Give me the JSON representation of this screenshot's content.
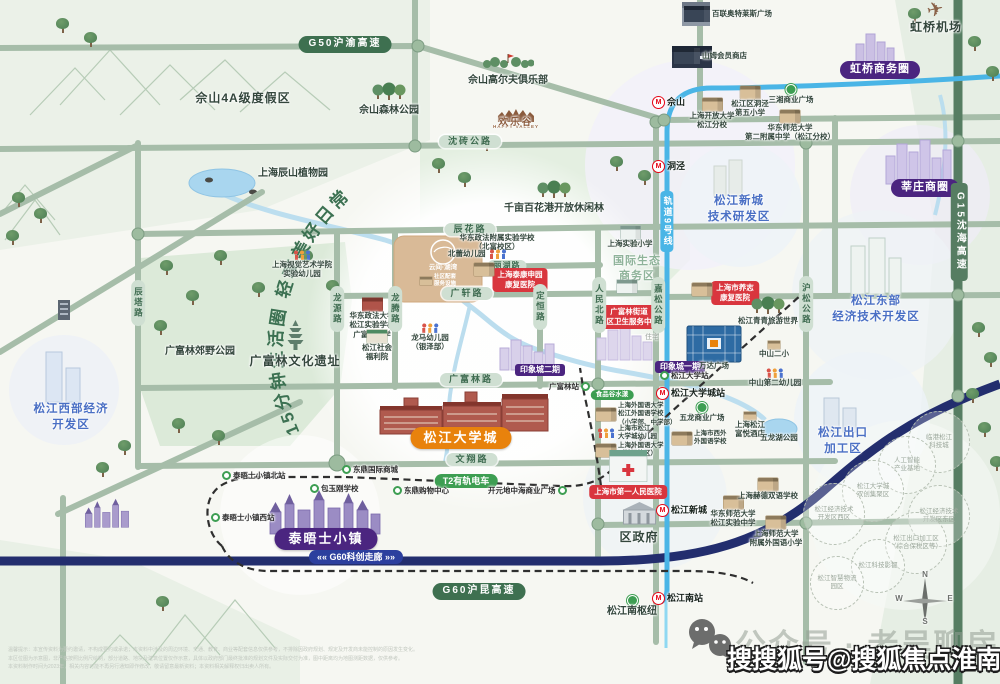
{
  "map": {
    "slogan": "15分钟生活圈  轻享美好日常",
    "labels": [
      {
        "n": "g50-highway-label",
        "l": [
          "G50沪渝高速"
        ],
        "x": 345,
        "y": 36,
        "s": "pd"
      },
      {
        "n": "sheshan-resort-label",
        "l": [
          "佘山4A级度假区"
        ],
        "x": 243,
        "y": 91,
        "s": "big"
      },
      {
        "n": "sheshan-forest-park",
        "l": [
          "佘山森林公园"
        ],
        "x": 389,
        "y": 82,
        "s": "med",
        "i": "trees"
      },
      {
        "n": "sheshan-golf-club",
        "l": [
          "佘山高尔夫俱乐部"
        ],
        "x": 508,
        "y": 52,
        "s": "med",
        "i": "golf"
      },
      {
        "n": "happy-valley-logo",
        "l": [
          "HAPPY VALLEY"
        ],
        "x": 516,
        "y": 108,
        "s": "hve",
        "i": "hvc"
      },
      {
        "n": "happy-valley-label",
        "l": [
          "欢乐谷"
        ],
        "x": 516,
        "y": 117,
        "s": "hv"
      },
      {
        "n": "shenzhuan-road-label",
        "l": [
          "沈砖公路"
        ],
        "x": 470,
        "y": 135,
        "s": "pl"
      },
      {
        "n": "bailian-outlet",
        "l": [
          "百联奥特莱斯广场"
        ],
        "x": 684,
        "y": 6,
        "s": "tiny",
        "r": 1,
        "i": "bldd"
      },
      {
        "n": "hongqiao-airport",
        "l": [
          "虹桥机场"
        ],
        "x": 936,
        "y": 0,
        "s": "big",
        "i": "plane"
      },
      {
        "n": "sams-club",
        "l": [
          "山姆会员商店"
        ],
        "x": 674,
        "y": 48,
        "s": "tiny",
        "r": 1,
        "i": "bldd"
      },
      {
        "n": "hongqiao-business-circle",
        "l": [
          "虹桥商务圈"
        ],
        "x": 880,
        "y": 61,
        "s": "pp"
      },
      {
        "n": "sheshan-metro-station",
        "l": [
          "佘山"
        ],
        "x": 652,
        "y": 96,
        "s": "st",
        "r": 1,
        "i": "m"
      },
      {
        "n": "dongjing-5th-primary",
        "l": [
          "松江区洞泾",
          "第五小学"
        ],
        "x": 750,
        "y": 86,
        "s": "tiny",
        "i": "bld"
      },
      {
        "n": "sanxiang-plaza",
        "l": [
          "三湘商业广场"
        ],
        "x": 791,
        "y": 84,
        "s": "tiny",
        "i": "dg"
      },
      {
        "n": "shanghai-open-univ",
        "l": [
          "上海开放大学",
          "松江分校"
        ],
        "x": 712,
        "y": 98,
        "s": "tiny",
        "i": "bld"
      },
      {
        "n": "ecnu-2nd-high",
        "l": [
          "华东师范大学",
          "第二附属中学（松江分校）"
        ],
        "x": 790,
        "y": 110,
        "s": "tiny",
        "i": "bld"
      },
      {
        "n": "dongjing-metro-station",
        "l": [
          "洞泾"
        ],
        "x": 652,
        "y": 160,
        "s": "st",
        "r": 1,
        "i": "m"
      },
      {
        "n": "xinzhuang-business-circle",
        "l": [
          "莘庄商圈"
        ],
        "x": 925,
        "y": 179,
        "s": "pp"
      },
      {
        "n": "sjxc-tech-zone",
        "l": [
          "松江新城",
          "技术研发区"
        ],
        "x": 739,
        "y": 194,
        "s": "zone"
      },
      {
        "n": "qianmu-baihua-forest",
        "l": [
          "千亩百花港开放休闲林"
        ],
        "x": 554,
        "y": 180,
        "s": "med",
        "i": "trees"
      },
      {
        "n": "chenhua-road-label",
        "l": [
          "辰花路"
        ],
        "x": 470,
        "y": 223,
        "s": "pl"
      },
      {
        "n": "chenshan-botanical-garden",
        "l": [
          "上海辰山植物园"
        ],
        "x": 293,
        "y": 168,
        "s": "med"
      },
      {
        "n": "eco-business-zone",
        "l": [
          "国际生态",
          "商务区"
        ],
        "x": 637,
        "y": 254,
        "s": "sage"
      },
      {
        "n": "sh-experimental-primary",
        "l": [
          "上海实验小学"
        ],
        "x": 630,
        "y": 226,
        "s": "tiny",
        "i": "bldw"
      },
      {
        "n": "ecupl-affiliated-school",
        "l": [
          "华东政法附属实验学校",
          "（北富校区）"
        ],
        "x": 497,
        "y": 233,
        "s": "tiny"
      },
      {
        "n": "beilei-kindergarten",
        "l": [
          "北蕾幼儿园"
        ],
        "x": 448,
        "y": 249,
        "s": "tiny",
        "r": 1,
        "i": "kids",
        "a": 1
      },
      {
        "n": "lihu-road-label",
        "l": [
          "丽湖路"
        ],
        "x": 507,
        "y": 260,
        "s": "pls"
      },
      {
        "n": "taikang-hospital-badge",
        "l": [
          "上海泰康申园",
          "康复医院"
        ],
        "x": 520,
        "y": 268,
        "s": "red"
      },
      {
        "n": "taikang-building",
        "l": [],
        "x": 484,
        "y": 263,
        "s": "ico",
        "i": "bld"
      },
      {
        "n": "guangxuan-road-label",
        "l": [
          "广轩路"
        ],
        "x": 467,
        "y": 287,
        "s": "pl"
      },
      {
        "n": "visual-arts-kindergarten",
        "l": [
          "上海视觉艺术学院",
          "实验幼儿园"
        ],
        "x": 302,
        "y": 250,
        "s": "tiny",
        "i": "kids"
      },
      {
        "n": "gfl-health-center-badge",
        "l": [
          "广富林街道",
          "社区卫生服务中心"
        ],
        "x": 629,
        "y": 305,
        "s": "red"
      },
      {
        "n": "gfl-health-building",
        "l": [],
        "x": 627,
        "y": 280,
        "s": "ico",
        "i": "bldw"
      },
      {
        "n": "yangzhi-hospital-badge",
        "l": [
          "上海市养志",
          "康复医院"
        ],
        "x": 735,
        "y": 281,
        "s": "red"
      },
      {
        "n": "yangzhi-building",
        "l": [],
        "x": 702,
        "y": 283,
        "s": "ico",
        "i": "bld"
      },
      {
        "n": "ecupl-sj-school",
        "l": [
          "华东政法大学",
          "松江实验学校",
          "广富林中学"
        ],
        "x": 372,
        "y": 298,
        "s": "tiny",
        "i": "bldr"
      },
      {
        "n": "sj-welfare-house",
        "l": [
          "松江社会",
          "福利院"
        ],
        "x": 377,
        "y": 330,
        "s": "tiny",
        "i": "bldg"
      },
      {
        "n": "longma-kindergarten",
        "l": [
          "龙马幼儿园",
          "（银泽部）"
        ],
        "x": 430,
        "y": 323,
        "s": "tiny",
        "i": "kids"
      },
      {
        "n": "project-name",
        "l": [
          "云间·湖湾"
        ],
        "x": 443,
        "y": 264,
        "s": "tinyw"
      },
      {
        "n": "project-services",
        "l": [
          "社区配套",
          "服务设施"
        ],
        "x": 420,
        "y": 274,
        "s": "tinyw2",
        "r": 1,
        "i": "blds"
      },
      {
        "n": "gfl-ruins",
        "l": [
          "广富林文化遗址"
        ],
        "x": 295,
        "y": 320,
        "s": "big",
        "i": "pag"
      },
      {
        "n": "gfl-country-park",
        "l": [
          "广富林郊野公园"
        ],
        "x": 200,
        "y": 346,
        "s": "med"
      },
      {
        "n": "sj-west-zone",
        "l": [
          "松江西部经济",
          "开发区"
        ],
        "x": 71,
        "y": 402,
        "s": "zone"
      },
      {
        "n": "chenta-road-label",
        "l": [
          "辰塔路"
        ],
        "x": 138,
        "y": 280,
        "s": "vp"
      },
      {
        "n": "longyuan-road-label",
        "l": [
          "龙源路"
        ],
        "x": 337,
        "y": 286,
        "s": "vp"
      },
      {
        "n": "longteng-road-label",
        "l": [
          "龙腾路"
        ],
        "x": 395,
        "y": 286,
        "s": "vp"
      },
      {
        "n": "dingheng-road-label",
        "l": [
          "定恒路"
        ],
        "x": 540,
        "y": 284,
        "s": "vp"
      },
      {
        "n": "renminbei-road-label",
        "l": [
          "人民北路"
        ],
        "x": 599,
        "y": 277,
        "s": "vp"
      },
      {
        "n": "jiasong-road-label",
        "l": [
          "嘉松公路"
        ],
        "x": 658,
        "y": 277,
        "s": "vp"
      },
      {
        "n": "husong-road-label",
        "l": [
          "沪松公路"
        ],
        "x": 806,
        "y": 276,
        "s": "vp"
      },
      {
        "n": "g15-highway-label",
        "l": [
          "G15沈海高速"
        ],
        "x": 959,
        "y": 183,
        "s": "vpd"
      },
      {
        "n": "metro-line9-label",
        "l": [
          "轨道9号线"
        ],
        "x": 667,
        "y": 191,
        "s": "vpb"
      },
      {
        "n": "residential-label",
        "l": [
          "住宅"
        ],
        "x": 652,
        "y": 334,
        "s": "gray"
      },
      {
        "n": "yinxiangcheng-phase2",
        "l": [
          "印象城二期"
        ],
        "x": 540,
        "y": 364,
        "s": "pps"
      },
      {
        "n": "yinxiangcheng-phase1",
        "l": [
          "印象城一期"
        ],
        "x": 680,
        "y": 361,
        "s": "pps"
      },
      {
        "n": "gfl-road-label",
        "l": [
          "广富林路"
        ],
        "x": 471,
        "y": 373,
        "s": "pl"
      },
      {
        "n": "gfl-tram-stop",
        "l": [
          "广富林站"
        ],
        "x": 549,
        "y": 382,
        "s": "ts",
        "r": 1,
        "i": "tg",
        "a": 1
      },
      {
        "n": "food-valley-badge",
        "l": [
          "食品谷水漾"
        ],
        "x": 612,
        "y": 390,
        "s": "pg"
      },
      {
        "n": "sjdxc-metro-station",
        "l": [
          "松江大学城站"
        ],
        "x": 656,
        "y": 387,
        "s": "st",
        "r": 1,
        "i": "m"
      },
      {
        "n": "sj-east-zone",
        "l": [
          "松江东部",
          "经济技术开发区"
        ],
        "x": 876,
        "y": 294,
        "s": "zone"
      },
      {
        "n": "wulong-plaza-stop",
        "l": [
          "五龙商业广场"
        ],
        "x": 702,
        "y": 402,
        "s": "tiny",
        "i": "dg"
      },
      {
        "n": "sisu-foreign-school",
        "l": [
          "上海外国语大学",
          "松江外国语学校",
          "（小学部、中学部）"
        ],
        "x": 596,
        "y": 402,
        "s": "ts2",
        "r": 1,
        "i": "bld"
      },
      {
        "n": "sjdxc-kindergarten",
        "l": [
          "上海市松江",
          "大学城幼儿园"
        ],
        "x": 596,
        "y": 425,
        "s": "ts2",
        "r": 1,
        "i": "kids"
      },
      {
        "n": "sisu-univ",
        "l": [
          "上海外国语大学",
          "（松江校区）"
        ],
        "x": 596,
        "y": 442,
        "s": "ts2",
        "r": 1,
        "i": "bld"
      },
      {
        "n": "xiwai-school",
        "l": [
          "上海市西外",
          "外国语学校"
        ],
        "x": 672,
        "y": 430,
        "s": "ts2",
        "r": 1,
        "i": "bld"
      },
      {
        "n": "fuyue-hotel",
        "l": [
          "上海松江",
          "富悦酒店"
        ],
        "x": 750,
        "y": 412,
        "s": "tiny",
        "i": "blds"
      },
      {
        "n": "wulong-lake-park",
        "l": [
          "五龙湖公园"
        ],
        "x": 779,
        "y": 433,
        "s": "tiny"
      },
      {
        "n": "sjdx-tram-stop",
        "l": [
          "松江大学站"
        ],
        "x": 660,
        "y": 371,
        "s": "ts",
        "r": 1,
        "i": "tg"
      },
      {
        "n": "wanda-plaza-label",
        "l": [
          "万达广场"
        ],
        "x": 714,
        "y": 361,
        "s": "tiny"
      },
      {
        "n": "zhongshan-2nd-primary",
        "l": [
          "中山二小"
        ],
        "x": 774,
        "y": 341,
        "s": "tiny",
        "i": "blds"
      },
      {
        "n": "zhongshan-2nd-kindergarten",
        "l": [
          "中山第二幼儿园"
        ],
        "x": 775,
        "y": 368,
        "s": "tiny",
        "i": "kids"
      },
      {
        "n": "qingqing-tourism-world",
        "l": [
          "松江青青旅游世界"
        ],
        "x": 768,
        "y": 296,
        "s": "tiny",
        "i": "trees"
      },
      {
        "n": "sjdxc-badge",
        "l": [
          "松江大学城"
        ],
        "x": 461,
        "y": 427,
        "s": "po"
      },
      {
        "n": "wenxiang-road-label",
        "l": [
          "文翔路"
        ],
        "x": 472,
        "y": 453,
        "s": "pl"
      },
      {
        "n": "dongding-intl-stop",
        "l": [
          "东鼎国际商城"
        ],
        "x": 342,
        "y": 465,
        "s": "ts",
        "r": 1,
        "i": "tg"
      },
      {
        "n": "baoyugang-school-stop",
        "l": [
          "包玉刚学校"
        ],
        "x": 310,
        "y": 484,
        "s": "ts",
        "r": 1,
        "i": "tg"
      },
      {
        "n": "t2-tram-badge",
        "l": [
          "T2有轨电车"
        ],
        "x": 466,
        "y": 474,
        "s": "pt"
      },
      {
        "n": "dongding-mall-stop",
        "l": [
          "东鼎购物中心"
        ],
        "x": 393,
        "y": 486,
        "s": "ts",
        "r": 1,
        "i": "tg"
      },
      {
        "n": "kaiyuan-plaza-stop",
        "l": [
          "开元地中海商业广场"
        ],
        "x": 488,
        "y": 486,
        "s": "ts",
        "r": 1,
        "i": "tg",
        "a": 1
      },
      {
        "n": "thames-north-stop",
        "l": [
          "泰晤士小镇北站"
        ],
        "x": 222,
        "y": 471,
        "s": "ts",
        "r": 1,
        "i": "tg"
      },
      {
        "n": "thames-west-stop",
        "l": [
          "泰晤士小镇西站"
        ],
        "x": 211,
        "y": 513,
        "s": "ts",
        "r": 1,
        "i": "tg"
      },
      {
        "n": "thames-town-badge",
        "l": [
          "泰晤士小镇"
        ],
        "x": 326,
        "y": 528,
        "s": "ppb"
      },
      {
        "n": "first-peoples-hospital",
        "l": [
          "上海市第一人民医院"
        ],
        "x": 628,
        "y": 450,
        "s": "red",
        "i": "hosp"
      },
      {
        "n": "district-government",
        "l": [
          "区政府"
        ],
        "x": 639,
        "y": 500,
        "s": "big",
        "i": "gov"
      },
      {
        "n": "sjxc-metro-station",
        "l": [
          "松江新城"
        ],
        "x": 656,
        "y": 504,
        "s": "st",
        "r": 1,
        "i": "m"
      },
      {
        "n": "ecnu-sj-high",
        "l": [
          "华东师范大学",
          "松江实验中学"
        ],
        "x": 733,
        "y": 496,
        "s": "tiny",
        "i": "bld"
      },
      {
        "n": "hede-school",
        "l": [
          "上海赫德双语学校"
        ],
        "x": 768,
        "y": 478,
        "s": "tiny",
        "i": "bld"
      },
      {
        "n": "shnu-foreign-primary",
        "l": [
          "上海师范大学",
          "附属外国语小学"
        ],
        "x": 776,
        "y": 516,
        "s": "tiny",
        "i": "bld"
      },
      {
        "n": "sj-export-zone",
        "l": [
          "松江出口",
          "加工区"
        ],
        "x": 843,
        "y": 426,
        "s": "zone"
      },
      {
        "n": "g60-corridor-badge",
        "l": [
          "«« G60科创走廊 »»"
        ],
        "x": 356,
        "y": 550,
        "s": "pb"
      },
      {
        "n": "g60-highway-label",
        "l": [
          "G60沪昆高速"
        ],
        "x": 479,
        "y": 583,
        "s": "pd"
      },
      {
        "n": "sjn-hub",
        "l": [
          "松江南枢纽"
        ],
        "x": 632,
        "y": 595,
        "s": "med",
        "i": "dg"
      },
      {
        "n": "sjn-metro-station",
        "l": [
          "松江南站"
        ],
        "x": 652,
        "y": 592,
        "s": "st",
        "r": 1,
        "i": "m"
      },
      {
        "n": "compass-n",
        "l": [
          "N"
        ],
        "x": 925,
        "y": 570,
        "s": "cmp"
      },
      {
        "n": "compass-w",
        "l": [
          "W"
        ],
        "x": 899,
        "y": 594,
        "s": "cmp"
      },
      {
        "n": "compass-e",
        "l": [
          "E"
        ],
        "x": 950,
        "y": 594,
        "s": "cmp"
      },
      {
        "n": "compass-s",
        "l": [
          "S"
        ],
        "x": 925,
        "y": 617,
        "s": "cmp"
      }
    ],
    "dashed_circles": [
      {
        "n": "zone-lingang-tech",
        "l": [
          "临港松江",
          "科技城"
        ],
        "x": 938,
        "y": 441,
        "r": 30
      },
      {
        "n": "zone-ai-base",
        "l": [
          "人工智能",
          "产业基地"
        ],
        "x": 906,
        "y": 464,
        "r": 28
      },
      {
        "n": "zone-univ-innovation",
        "l": [
          "松江大学城",
          "双创集聚区"
        ],
        "x": 872,
        "y": 490,
        "r": 30
      },
      {
        "n": "zone-edz-west",
        "l": [
          "松江经济技术",
          "开发区西区"
        ],
        "x": 833,
        "y": 513,
        "r": 30
      },
      {
        "n": "zone-edz-east",
        "l": [
          "松江经济技术",
          "开发区东区"
        ],
        "x": 938,
        "y": 515,
        "r": 30
      },
      {
        "n": "zone-export-bonded",
        "l": [
          "松江出口加工区",
          "（综合保税区等）"
        ],
        "x": 915,
        "y": 542,
        "r": 30
      },
      {
        "n": "zone-film-capital",
        "l": [
          "松江科技影都"
        ],
        "x": 877,
        "y": 565,
        "r": 26
      },
      {
        "n": "zone-smart-logistics",
        "l": [
          "松江智慧物流",
          "园区"
        ],
        "x": 836,
        "y": 582,
        "r": 26
      }
    ]
  },
  "watermark": {
    "gray": "公众号 · 老吴聊房",
    "white": "搜搜狐号@搜狐焦点淮南站"
  },
  "footer": {
    "line1": "温馨提示：本宣传资料为要约邀请，不构成要约或承诺；本资料中涉及的周边环境、交通、教育、商业等配套信息仅供参考，不排除因政府规划、规定及开发商未能控制的原因发生变化。",
    "line2": "本区位图为示意图，非严格按照比例尺绘制，部分道路、地块及建筑位置仅作示意，具体以政府部门最终批准的规划文件及实际交付为准，图中距离均为地图测距数据，仅供参考。",
    "line3": "本资料制作时间为2023年，相关内容可能不再另行通知即作修改，敬请留意最新资料；本资料相关解释权归出卖人所有。"
  }
}
